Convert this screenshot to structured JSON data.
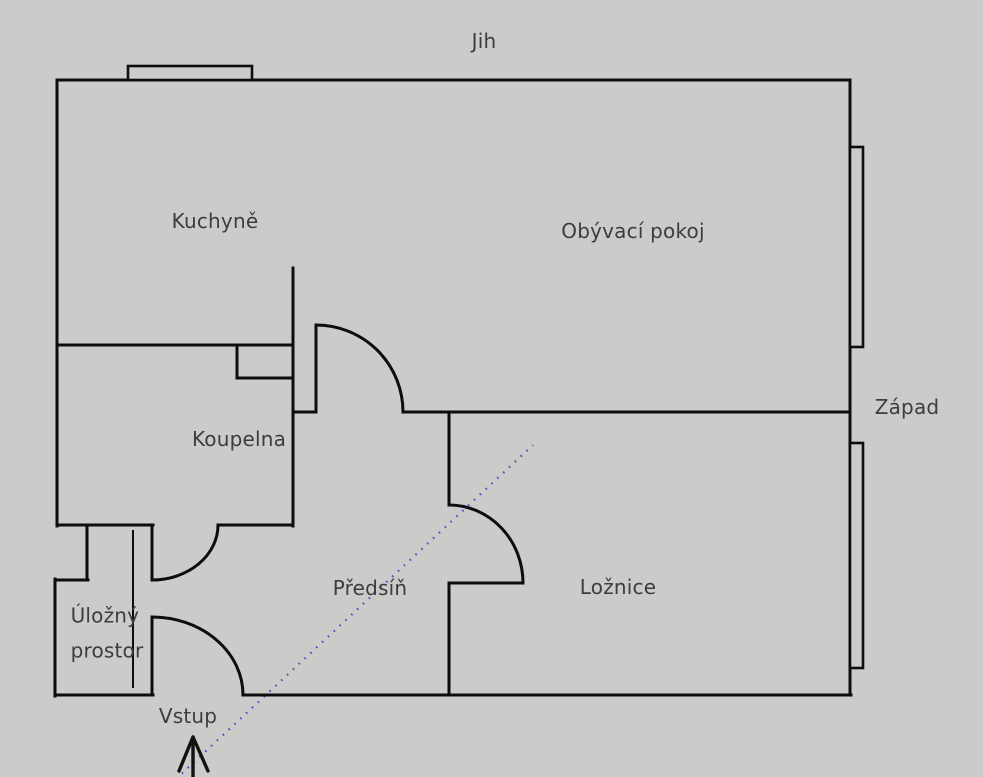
{
  "compass": {
    "south_label": "Jih",
    "west_label": "Západ"
  },
  "rooms": {
    "kitchen": "Kuchyně",
    "living_room": "Obývací pokoj",
    "bathroom": "Koupelna",
    "hallway": "Předsíň",
    "bedroom": "Ložnice",
    "storage_line1": "Úložný",
    "storage_line2": "prostor"
  },
  "entrance": {
    "label": "Vstup"
  },
  "colors": {
    "background": "#cccbc9",
    "wall": "#0d0d0d",
    "label": "#3d3d3d",
    "entry_path": "#3a3ac8"
  }
}
